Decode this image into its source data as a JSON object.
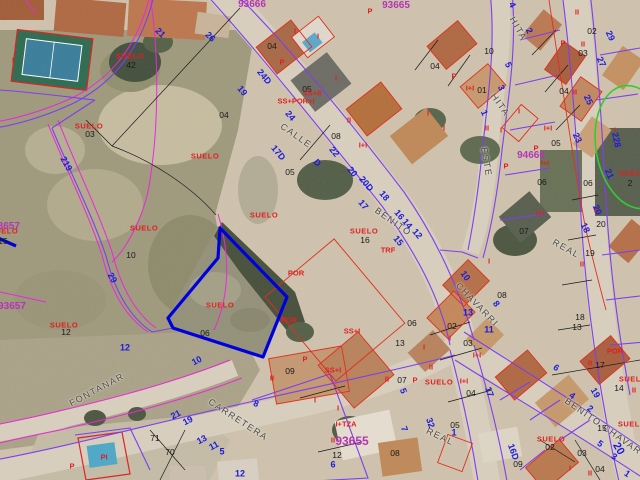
{
  "map": {
    "type": "cadastral-aerial-map",
    "selected_parcel_color": "#0000dd",
    "parcel_line_color": "#7d3ff0",
    "old_boundary_color": "#e829d8",
    "building_line_color": "#e03020",
    "street_number_color": "#1b1bdf",
    "block_number_color": "#b535b5",
    "suelo_label_color": "#e02020",
    "street_name_color": "#4a4a4a",
    "highlight_ellipse_color": "#33cc33"
  },
  "labels": [
    {
      "t": "CALLE",
      "x": 296,
      "y": 136,
      "c": "street",
      "r": 35
    },
    {
      "t": "BENITO",
      "x": 393,
      "y": 222,
      "c": "street",
      "r": 35
    },
    {
      "t": "CHAVARRI",
      "x": 477,
      "y": 305,
      "c": "street",
      "r": 46
    },
    {
      "t": "HITA",
      "x": 518,
      "y": 29,
      "c": "street",
      "r": 60
    },
    {
      "t": "HITA",
      "x": 500,
      "y": 105,
      "c": "street",
      "r": 55
    },
    {
      "t": "ESTE",
      "x": 486,
      "y": 162,
      "c": "street",
      "r": 80
    },
    {
      "t": "CARRETERA",
      "x": 238,
      "y": 420,
      "c": "street",
      "r": 33
    },
    {
      "t": "FONTANAR",
      "x": 97,
      "y": 390,
      "c": "street",
      "r": -28
    },
    {
      "t": "REAL",
      "x": 440,
      "y": 437,
      "c": "street",
      "r": 25
    },
    {
      "t": "REAL",
      "x": 566,
      "y": 249,
      "c": "street",
      "r": 29
    },
    {
      "t": "BENITO CHAVARRI",
      "x": 608,
      "y": 430,
      "c": "street",
      "r": 35
    },
    {
      "t": "93666",
      "x": 252,
      "y": 5,
      "c": "mag",
      "r": 0
    },
    {
      "t": "93665",
      "x": 396,
      "y": 6,
      "c": "mag",
      "r": 0
    },
    {
      "t": "94666",
      "x": 531,
      "y": 156,
      "c": "mag",
      "r": 0
    },
    {
      "t": "93657",
      "x": 6,
      "y": 227,
      "c": "mag",
      "r": 0
    },
    {
      "t": "93657",
      "x": 12,
      "y": 307,
      "c": "mag",
      "r": 0
    },
    {
      "t": "93655",
      "x": 352,
      "y": 441,
      "c": "mag",
      "r": 0,
      "s": 12
    },
    {
      "t": "SUELO",
      "x": 130,
      "y": 56,
      "c": "suelo",
      "r": 0
    },
    {
      "t": "42",
      "x": 131,
      "y": 65,
      "c": "black",
      "r": 0
    },
    {
      "t": "SUELO",
      "x": 89,
      "y": 126,
      "c": "suelo",
      "r": 0
    },
    {
      "t": "03",
      "x": 90,
      "y": 134,
      "c": "black",
      "r": 0
    },
    {
      "t": "SUELO",
      "x": 205,
      "y": 156,
      "c": "suelo",
      "r": 0
    },
    {
      "t": "SUELO",
      "x": 144,
      "y": 228,
      "c": "suelo",
      "r": 0
    },
    {
      "t": "10",
      "x": 131,
      "y": 255,
      "c": "black",
      "r": 0
    },
    {
      "t": "SUELO",
      "x": 264,
      "y": 215,
      "c": "suelo",
      "r": 0
    },
    {
      "t": "SUELO",
      "x": 364,
      "y": 231,
      "c": "suelo",
      "r": 0
    },
    {
      "t": "16",
      "x": 365,
      "y": 240,
      "c": "black",
      "r": 0
    },
    {
      "t": "SUELO",
      "x": 220,
      "y": 305,
      "c": "suelo",
      "r": 0
    },
    {
      "t": "SUELO",
      "x": 64,
      "y": 325,
      "c": "suelo",
      "r": 0
    },
    {
      "t": "12",
      "x": 66,
      "y": 332,
      "c": "black",
      "r": 0
    },
    {
      "t": "SUELO",
      "x": 551,
      "y": 439,
      "c": "suelo",
      "r": 0
    },
    {
      "t": "02",
      "x": 550,
      "y": 447,
      "c": "black",
      "r": 0
    },
    {
      "t": "SUELO",
      "x": 633,
      "y": 379,
      "c": "suelo",
      "r": 0
    },
    {
      "t": "SUELO",
      "x": 632,
      "y": 424,
      "c": "suelo",
      "r": 0
    },
    {
      "t": "15",
      "x": 602,
      "y": 428,
      "c": "black",
      "r": 0
    },
    {
      "t": "SUELO",
      "x": 633,
      "y": 173,
      "c": "suelo",
      "r": 0
    },
    {
      "t": "2",
      "x": 630,
      "y": 183,
      "c": "black",
      "r": 0
    },
    {
      "t": "SUELO",
      "x": 4,
      "y": 231,
      "c": "suelo",
      "r": 0
    },
    {
      "t": "15",
      "x": 3,
      "y": 241,
      "c": "black",
      "r": 0
    },
    {
      "t": "SUELO",
      "x": 439,
      "y": 382,
      "c": "suelo",
      "r": 0
    },
    {
      "t": "05",
      "x": 290,
      "y": 172,
      "c": "black",
      "r": 0
    },
    {
      "t": "04",
      "x": 272,
      "y": 46,
      "c": "black",
      "r": 0
    },
    {
      "t": "05",
      "x": 307,
      "y": 89,
      "c": "black",
      "r": 0
    },
    {
      "t": "08",
      "x": 336,
      "y": 136,
      "c": "black",
      "r": 0
    },
    {
      "t": "04",
      "x": 224,
      "y": 115,
      "c": "black",
      "r": 0
    },
    {
      "t": "04",
      "x": 435,
      "y": 66,
      "c": "black",
      "r": 0
    },
    {
      "t": "10",
      "x": 489,
      "y": 51,
      "c": "black",
      "r": 0
    },
    {
      "t": "01",
      "x": 482,
      "y": 90,
      "c": "black",
      "r": 0
    },
    {
      "t": "02",
      "x": 592,
      "y": 31,
      "c": "black",
      "r": 0
    },
    {
      "t": "03",
      "x": 583,
      "y": 53,
      "c": "black",
      "r": 0
    },
    {
      "t": "04",
      "x": 564,
      "y": 91,
      "c": "black",
      "r": 0
    },
    {
      "t": "05",
      "x": 556,
      "y": 143,
      "c": "black",
      "r": 0
    },
    {
      "t": "06",
      "x": 542,
      "y": 182,
      "c": "black",
      "r": 0
    },
    {
      "t": "06",
      "x": 588,
      "y": 183,
      "c": "black",
      "r": 0
    },
    {
      "t": "07",
      "x": 524,
      "y": 231,
      "c": "black",
      "r": 0
    },
    {
      "t": "20",
      "x": 601,
      "y": 224,
      "c": "black",
      "r": 0
    },
    {
      "t": "19",
      "x": 590,
      "y": 253,
      "c": "black",
      "r": 0
    },
    {
      "t": "18",
      "x": 580,
      "y": 317,
      "c": "black",
      "r": 0
    },
    {
      "t": "17",
      "x": 600,
      "y": 365,
      "c": "black",
      "r": 0
    },
    {
      "t": "14",
      "x": 619,
      "y": 388,
      "c": "black",
      "r": 0
    },
    {
      "t": "13",
      "x": 577,
      "y": 327,
      "c": "black",
      "r": 0
    },
    {
      "t": "13",
      "x": 400,
      "y": 343,
      "c": "black",
      "r": 0
    },
    {
      "t": "06",
      "x": 412,
      "y": 323,
      "c": "black",
      "r": 0
    },
    {
      "t": "07",
      "x": 402,
      "y": 380,
      "c": "black",
      "r": 0
    },
    {
      "t": "08",
      "x": 395,
      "y": 453,
      "c": "black",
      "r": 0
    },
    {
      "t": "09",
      "x": 290,
      "y": 371,
      "c": "black",
      "r": 0
    },
    {
      "t": "09",
      "x": 518,
      "y": 464,
      "c": "black",
      "r": 0
    },
    {
      "t": "12",
      "x": 337,
      "y": 455,
      "c": "black",
      "r": 0
    },
    {
      "t": "02",
      "x": 452,
      "y": 326,
      "c": "black",
      "r": 0
    },
    {
      "t": "03",
      "x": 468,
      "y": 343,
      "c": "black",
      "r": 0
    },
    {
      "t": "04",
      "x": 471,
      "y": 393,
      "c": "black",
      "r": 0
    },
    {
      "t": "05",
      "x": 455,
      "y": 425,
      "c": "black",
      "r": 0
    },
    {
      "t": "08",
      "x": 502,
      "y": 295,
      "c": "black",
      "r": 0
    },
    {
      "t": "06",
      "x": 205,
      "y": 333,
      "c": "black",
      "r": 0
    },
    {
      "t": "71",
      "x": 155,
      "y": 438,
      "c": "black",
      "r": 0
    },
    {
      "t": "70",
      "x": 170,
      "y": 452,
      "c": "black",
      "r": 0
    },
    {
      "t": "03",
      "x": 582,
      "y": 453,
      "c": "black",
      "r": 0
    },
    {
      "t": "04",
      "x": 600,
      "y": 469,
      "c": "black",
      "r": 0
    },
    {
      "t": "I",
      "x": 13,
      "y": 60,
      "c": "red",
      "r": 0
    },
    {
      "t": "I",
      "x": 295,
      "y": 31,
      "c": "red",
      "r": 0
    },
    {
      "t": "I",
      "x": 318,
      "y": 36,
      "c": "red",
      "r": 0
    },
    {
      "t": "P",
      "x": 282,
      "y": 62,
      "c": "red",
      "r": 0
    },
    {
      "t": "P",
      "x": 370,
      "y": 11,
      "c": "red",
      "r": 0
    },
    {
      "t": "SS+II",
      "x": 312,
      "y": 93,
      "c": "red",
      "r": 0
    },
    {
      "t": "SS+POR+I",
      "x": 296,
      "y": 101,
      "c": "red",
      "r": 0
    },
    {
      "t": "I",
      "x": 336,
      "y": 78,
      "c": "red",
      "r": 0
    },
    {
      "t": "II",
      "x": 349,
      "y": 120,
      "c": "red",
      "r": 0
    },
    {
      "t": "I+I",
      "x": 363,
      "y": 145,
      "c": "red",
      "r": 0
    },
    {
      "t": "P",
      "x": 454,
      "y": 76,
      "c": "red",
      "r": 0
    },
    {
      "t": "I",
      "x": 428,
      "y": 113,
      "c": "red",
      "r": 0
    },
    {
      "t": "I",
      "x": 444,
      "y": 128,
      "c": "red",
      "r": 0
    },
    {
      "t": "I+I",
      "x": 470,
      "y": 88,
      "c": "red",
      "r": 0
    },
    {
      "t": "II",
      "x": 487,
      "y": 128,
      "c": "red",
      "r": 0
    },
    {
      "t": "II",
      "x": 577,
      "y": 12,
      "c": "red",
      "r": 0
    },
    {
      "t": "II",
      "x": 583,
      "y": 44,
      "c": "red",
      "r": 0
    },
    {
      "t": "II",
      "x": 575,
      "y": 92,
      "c": "red",
      "r": 0
    },
    {
      "t": "P",
      "x": 563,
      "y": 43,
      "c": "red",
      "r": 0
    },
    {
      "t": "I+I",
      "x": 548,
      "y": 128,
      "c": "red",
      "r": 0
    },
    {
      "t": "I+I",
      "x": 545,
      "y": 163,
      "c": "red",
      "r": 0
    },
    {
      "t": "I+I",
      "x": 540,
      "y": 213,
      "c": "red",
      "r": 0
    },
    {
      "t": "P",
      "x": 536,
      "y": 148,
      "c": "red",
      "r": 0
    },
    {
      "t": "P",
      "x": 506,
      "y": 166,
      "c": "red",
      "r": 0
    },
    {
      "t": "I",
      "x": 519,
      "y": 111,
      "c": "red",
      "r": 0
    },
    {
      "t": "I",
      "x": 501,
      "y": 130,
      "c": "red",
      "r": 0
    },
    {
      "t": "I",
      "x": 615,
      "y": 130,
      "c": "red",
      "r": 0
    },
    {
      "t": "TRF",
      "x": 388,
      "y": 250,
      "c": "red",
      "r": 0
    },
    {
      "t": "I",
      "x": 489,
      "y": 261,
      "c": "red",
      "r": 0
    },
    {
      "t": "POR",
      "x": 296,
      "y": 273,
      "c": "red",
      "r": 0
    },
    {
      "t": "POR",
      "x": 289,
      "y": 320,
      "c": "red",
      "r": 0
    },
    {
      "t": "SS+I",
      "x": 352,
      "y": 331,
      "c": "red",
      "r": 0
    },
    {
      "t": "SS+I",
      "x": 333,
      "y": 370,
      "c": "red",
      "r": 0
    },
    {
      "t": "P",
      "x": 305,
      "y": 359,
      "c": "red",
      "r": 0
    },
    {
      "t": "II",
      "x": 272,
      "y": 378,
      "c": "red",
      "r": 0
    },
    {
      "t": "I",
      "x": 315,
      "y": 400,
      "c": "red",
      "r": 0
    },
    {
      "t": "I",
      "x": 338,
      "y": 408,
      "c": "red",
      "r": 0
    },
    {
      "t": "I+TZA",
      "x": 346,
      "y": 424,
      "c": "red",
      "r": 0
    },
    {
      "t": "II",
      "x": 333,
      "y": 440,
      "c": "red",
      "r": 0
    },
    {
      "t": "II",
      "x": 590,
      "y": 363,
      "c": "red",
      "r": 0
    },
    {
      "t": "POR",
      "x": 615,
      "y": 351,
      "c": "red",
      "r": 0
    },
    {
      "t": "II",
      "x": 634,
      "y": 390,
      "c": "red",
      "r": 0
    },
    {
      "t": "I",
      "x": 450,
      "y": 338,
      "c": "red",
      "r": 0
    },
    {
      "t": "I+I",
      "x": 477,
      "y": 355,
      "c": "red",
      "r": 0
    },
    {
      "t": "I+I",
      "x": 464,
      "y": 381,
      "c": "red",
      "r": 0
    },
    {
      "t": "II",
      "x": 431,
      "y": 367,
      "c": "red",
      "r": 0
    },
    {
      "t": "I",
      "x": 424,
      "y": 347,
      "c": "red",
      "r": 0
    },
    {
      "t": "II",
      "x": 387,
      "y": 379,
      "c": "red",
      "r": 0
    },
    {
      "t": "P",
      "x": 415,
      "y": 380,
      "c": "red",
      "r": 0
    },
    {
      "t": "II",
      "x": 596,
      "y": 210,
      "c": "red",
      "r": 0
    },
    {
      "t": "II",
      "x": 582,
      "y": 264,
      "c": "red",
      "r": 0
    },
    {
      "t": "PI",
      "x": 104,
      "y": 457,
      "c": "red",
      "r": 0
    },
    {
      "t": "P",
      "x": 72,
      "y": 466,
      "c": "red",
      "r": 0
    },
    {
      "t": "II",
      "x": 590,
      "y": 473,
      "c": "red",
      "r": 0
    },
    {
      "t": "I",
      "x": 570,
      "y": 468,
      "c": "red",
      "r": 0
    },
    {
      "t": "21",
      "x": 160,
      "y": 33,
      "c": "blue",
      "r": 45
    },
    {
      "t": "26",
      "x": 210,
      "y": 37,
      "c": "blue",
      "r": 45
    },
    {
      "t": "19",
      "x": 242,
      "y": 91,
      "c": "blue",
      "r": 50
    },
    {
      "t": "24D",
      "x": 264,
      "y": 77,
      "c": "blue",
      "r": 50
    },
    {
      "t": "24",
      "x": 290,
      "y": 116,
      "c": "blue",
      "r": 50
    },
    {
      "t": "17D",
      "x": 278,
      "y": 153,
      "c": "blue",
      "r": 50
    },
    {
      "t": "22",
      "x": 334,
      "y": 152,
      "c": "blue",
      "r": 50
    },
    {
      "t": "D",
      "x": 317,
      "y": 163,
      "c": "blue",
      "r": 50
    },
    {
      "t": "20",
      "x": 352,
      "y": 172,
      "c": "blue",
      "r": 50
    },
    {
      "t": "20D",
      "x": 366,
      "y": 184,
      "c": "blue",
      "r": 50
    },
    {
      "t": "18",
      "x": 384,
      "y": 196,
      "c": "blue",
      "r": 50
    },
    {
      "t": "17",
      "x": 363,
      "y": 205,
      "c": "blue",
      "r": 50
    },
    {
      "t": "16",
      "x": 399,
      "y": 215,
      "c": "blue",
      "r": 50
    },
    {
      "t": "14",
      "x": 407,
      "y": 224,
      "c": "blue",
      "r": 50
    },
    {
      "t": "12",
      "x": 417,
      "y": 234,
      "c": "blue",
      "r": 50
    },
    {
      "t": "15",
      "x": 398,
      "y": 241,
      "c": "blue",
      "r": 50
    },
    {
      "t": "10",
      "x": 465,
      "y": 276,
      "c": "blue",
      "r": 55
    },
    {
      "t": "8",
      "x": 496,
      "y": 304,
      "c": "blue",
      "r": 55
    },
    {
      "t": "13",
      "x": 468,
      "y": 313,
      "c": "blue",
      "r": 0
    },
    {
      "t": "11",
      "x": 489,
      "y": 330,
      "c": "blue",
      "r": 0
    },
    {
      "t": "4",
      "x": 512,
      "y": 5,
      "c": "blue",
      "r": 65
    },
    {
      "t": "2",
      "x": 529,
      "y": 31,
      "c": "blue",
      "r": 65
    },
    {
      "t": "5",
      "x": 508,
      "y": 65,
      "c": "blue",
      "r": 65
    },
    {
      "t": "3",
      "x": 501,
      "y": 88,
      "c": "blue",
      "r": 65
    },
    {
      "t": "1",
      "x": 484,
      "y": 113,
      "c": "blue",
      "r": 65
    },
    {
      "t": "29",
      "x": 610,
      "y": 36,
      "c": "blue",
      "r": 65
    },
    {
      "t": "27",
      "x": 601,
      "y": 62,
      "c": "blue",
      "r": 65
    },
    {
      "t": "25",
      "x": 588,
      "y": 100,
      "c": "blue",
      "r": 65
    },
    {
      "t": "23",
      "x": 577,
      "y": 138,
      "c": "blue",
      "r": 65
    },
    {
      "t": "228",
      "x": 616,
      "y": 140,
      "c": "blue",
      "r": 78
    },
    {
      "t": "21",
      "x": 609,
      "y": 174,
      "c": "blue",
      "r": 68
    },
    {
      "t": "20",
      "x": 597,
      "y": 210,
      "c": "blue",
      "r": 65
    },
    {
      "t": "18",
      "x": 585,
      "y": 228,
      "c": "blue",
      "r": 65
    },
    {
      "t": "19",
      "x": 595,
      "y": 393,
      "c": "blue",
      "r": 60
    },
    {
      "t": "219",
      "x": 66,
      "y": 164,
      "c": "blue",
      "r": 61
    },
    {
      "t": "29",
      "x": 112,
      "y": 278,
      "c": "blue",
      "r": 60
    },
    {
      "t": "12",
      "x": 125,
      "y": 348,
      "c": "blue",
      "r": 0
    },
    {
      "t": "10",
      "x": 197,
      "y": 361,
      "c": "blue",
      "r": -28
    },
    {
      "t": "21",
      "x": 176,
      "y": 415,
      "c": "blue",
      "r": -28
    },
    {
      "t": "19",
      "x": 188,
      "y": 421,
      "c": "blue",
      "r": -28
    },
    {
      "t": "13",
      "x": 202,
      "y": 440,
      "c": "blue",
      "r": -28
    },
    {
      "t": "11",
      "x": 214,
      "y": 446,
      "c": "blue",
      "r": -28
    },
    {
      "t": "8",
      "x": 256,
      "y": 404,
      "c": "blue",
      "r": 20
    },
    {
      "t": "6",
      "x": 333,
      "y": 465,
      "c": "blue",
      "r": 0
    },
    {
      "t": "5",
      "x": 222,
      "y": 452,
      "c": "blue",
      "r": 0
    },
    {
      "t": "12",
      "x": 240,
      "y": 474,
      "c": "blue",
      "r": 0
    },
    {
      "t": "17",
      "x": 489,
      "y": 392,
      "c": "blue",
      "r": 70
    },
    {
      "t": "16D",
      "x": 513,
      "y": 452,
      "c": "blue",
      "r": 70
    },
    {
      "t": "32",
      "x": 430,
      "y": 423,
      "c": "blue",
      "r": 70
    },
    {
      "t": "5",
      "x": 403,
      "y": 391,
      "c": "blue",
      "r": 70
    },
    {
      "t": "7",
      "x": 404,
      "y": 429,
      "c": "blue",
      "r": 70
    },
    {
      "t": "1",
      "x": 454,
      "y": 433,
      "c": "blue",
      "r": 0
    },
    {
      "t": "6",
      "x": 556,
      "y": 368,
      "c": "blue",
      "r": 35
    },
    {
      "t": "4",
      "x": 572,
      "y": 396,
      "c": "blue",
      "r": 35
    },
    {
      "t": "2",
      "x": 590,
      "y": 409,
      "c": "blue",
      "r": 35
    },
    {
      "t": "5",
      "x": 600,
      "y": 444,
      "c": "blue",
      "r": 35
    },
    {
      "t": "3",
      "x": 614,
      "y": 457,
      "c": "blue",
      "r": 35
    },
    {
      "t": "1",
      "x": 627,
      "y": 474,
      "c": "blue",
      "r": 35
    },
    {
      "t": "20",
      "x": 618,
      "y": 449,
      "c": "blue",
      "r": 60,
      "s": 11
    }
  ]
}
